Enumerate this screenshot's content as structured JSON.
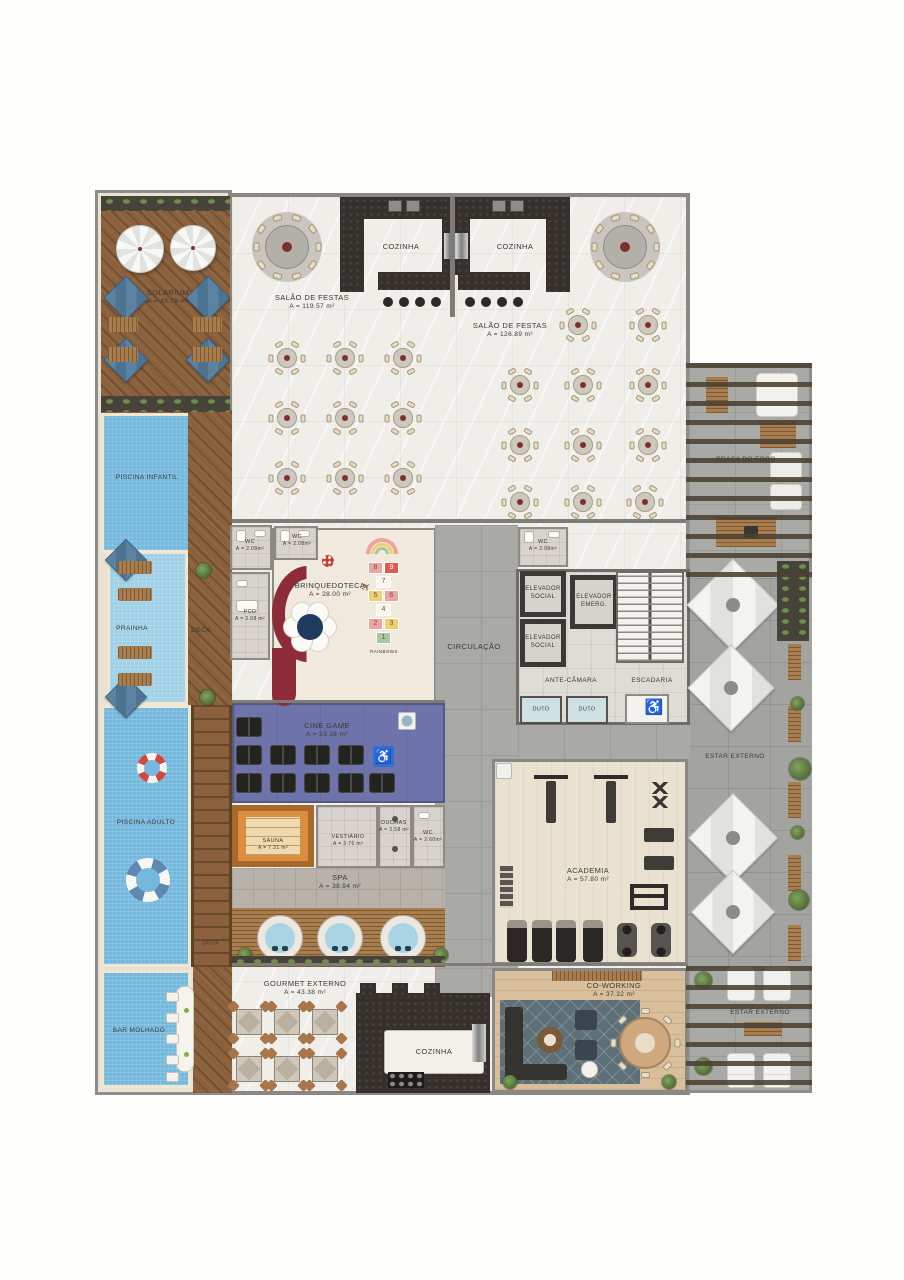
{
  "rooms": {
    "solarium": {
      "name": "SOLARIUM",
      "area": "A = 43.78 m²"
    },
    "piscina_infantil": {
      "name": "PISCINA INFANTIL"
    },
    "prainha": {
      "name": "PRAINHA"
    },
    "deck_upper": {
      "name": "DECK"
    },
    "deck_lap": {
      "name": "DECK"
    },
    "piscina_adulto": {
      "name": "PISCINA ADULTO"
    },
    "bar_molhado": {
      "name": "BAR MOLHADO"
    },
    "salao_festas_1": {
      "name": "SALÃO DE FESTAS",
      "area": "A = 119.57 m²"
    },
    "cozinha_1": {
      "name": "COZINHA"
    },
    "cozinha_2": {
      "name": "COZINHA"
    },
    "salao_festas_2": {
      "name": "SALÃO DE FESTAS",
      "area": "A = 126.89 m²"
    },
    "praca_do_fogo": {
      "name": "PRAÇA DO FOGO"
    },
    "wc_1": {
      "name": "WC",
      "area": "A = 2.08m²"
    },
    "wc_2": {
      "name": "WC",
      "area": "A = 2.08m²"
    },
    "wc_3": {
      "name": "WC",
      "area": "A = 2.08m²"
    },
    "pcd": {
      "name": "PCD",
      "area": "A = 3.68 m²"
    },
    "brinquedoteca": {
      "name": "BRINQUEDOTECA",
      "area": "A = 28.00 m²"
    },
    "circulacao": {
      "name": "CIRCULAÇÃO"
    },
    "elevador_social_1": {
      "name": "ELEVADOR SOCIAL"
    },
    "elevador_emerg": {
      "name": "ELEVADOR EMERG."
    },
    "elevador_social_2": {
      "name": "ELEVADOR SOCIAL"
    },
    "ante_camara": {
      "name": "ANTE-CÂMARA"
    },
    "escadaria": {
      "name": "ESCADARIA"
    },
    "duto_1": {
      "name": "DUTO"
    },
    "duto_2": {
      "name": "DUTO"
    },
    "cine_game": {
      "name": "CINE GAME",
      "area": "A = 33.38 m²"
    },
    "sauna": {
      "name": "SAUNA",
      "area": "A = 7.31 m²"
    },
    "vestiario": {
      "name": "VESTIÁRIO",
      "area": "A = 3.76 m²"
    },
    "duchas": {
      "name": "DUCHAS",
      "area": "A = 3.58 m²"
    },
    "wc_4": {
      "name": "WC",
      "area": "A = 2.60m²"
    },
    "spa": {
      "name": "SPA",
      "area": "A = 38.94 m²"
    },
    "academia": {
      "name": "ACADEMIA",
      "area": "A = 57.80 m²"
    },
    "estar_externo_1": {
      "name": "ESTAR EXTERNO"
    },
    "gourmet_externo": {
      "name": "GOURMET EXTERNO",
      "area": "A = 43.38 m²"
    },
    "cozinha_3": {
      "name": "COZINHA"
    },
    "coworking": {
      "name": "CO-WORKING",
      "area": "A = 37.32 m²"
    },
    "estar_externo_2": {
      "name": "ESTAR EXTERNO"
    }
  },
  "hopscotch": {
    "n1": "1",
    "n2": "2",
    "n3": "3",
    "n4": "4",
    "n5": "5",
    "n6": "6",
    "n7": "7",
    "n8": "8",
    "n9": "9",
    "caption": "RAINBOWS"
  },
  "icons": {
    "wheelchair": "♿",
    "plane": "✈"
  },
  "colors": {
    "pool": "#74b8dd",
    "wood": "#8a613c",
    "granite": "#35302c",
    "cine_purple": "#6f73ab",
    "concrete": "#a9a9a6",
    "sofa_maroon": "#8d2c38",
    "hs_red": "#dd5c52",
    "hs_yellow": "#efcf6f",
    "hs_green": "#a9c79b",
    "hs_pink": "#f0a39b",
    "badge_blue": "#2f6fd0"
  }
}
